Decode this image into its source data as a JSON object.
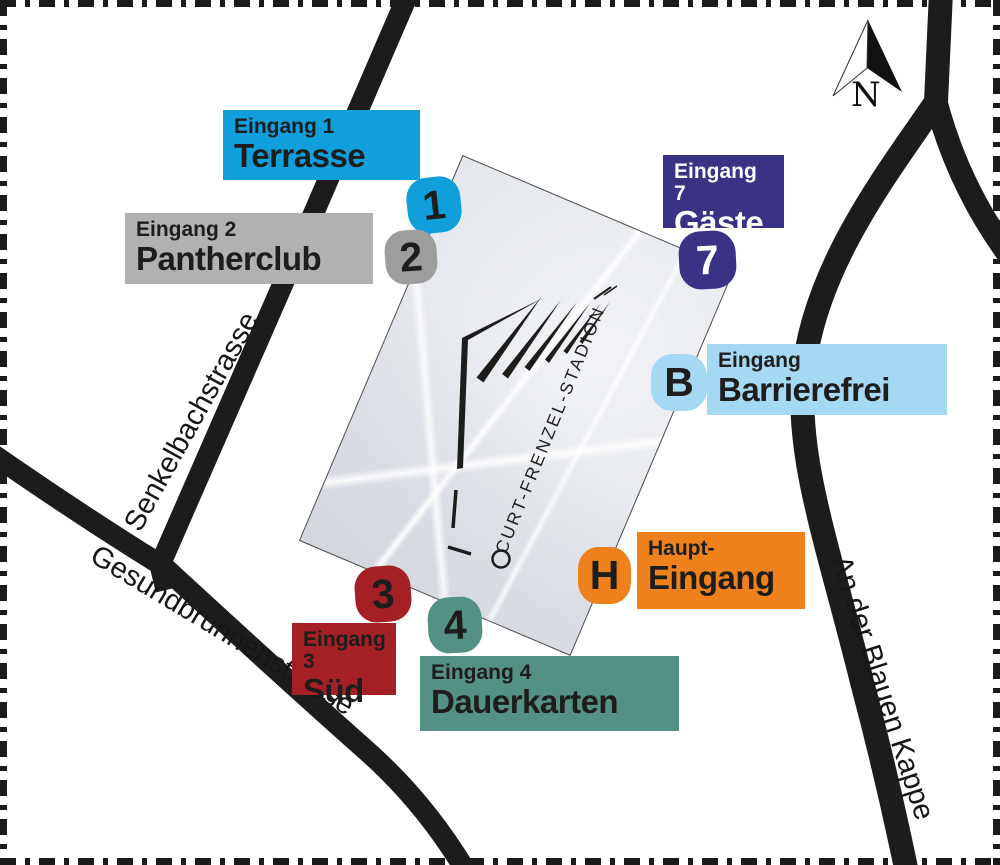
{
  "compass": {
    "label": "N"
  },
  "stadium": {
    "name": "CURT-FRENZEL-STADION"
  },
  "streets": {
    "senkelbach": {
      "name": "Senkelbachstrasse"
    },
    "gesundbrunnen": {
      "name": "Gesundbrunnenstrasse"
    },
    "blauekappe": {
      "name": "An der Blauen Kappe"
    }
  },
  "entrances": {
    "terrasse": {
      "badge": "1",
      "line1": "Eingang 1",
      "line2": "Terrasse",
      "bg": "#119fdc",
      "badge_bg": "#119fdc",
      "fg": "#1d1d1b",
      "badge_fg": "#1d1d1b"
    },
    "pantherclub": {
      "badge": "2",
      "line1": "Eingang 2",
      "line2": "Pantherclub",
      "bg": "#b1b1b0",
      "badge_bg": "#9d9d9c",
      "fg": "#1d1d1b",
      "badge_fg": "#1d1d1b"
    },
    "gaeste": {
      "badge": "7",
      "line1": "Eingang 7",
      "line2": "Gäste",
      "bg": "#3a3285",
      "badge_bg": "#3a3285",
      "fg": "#ffffff",
      "badge_fg": "#ffffff"
    },
    "barrierefrei": {
      "badge": "B",
      "line1": "Eingang",
      "line2": "Barrierefrei",
      "bg": "#a5d8f3",
      "badge_bg": "#a5d8f3",
      "fg": "#1d1d1b",
      "badge_fg": "#1d1d1b"
    },
    "haupteingang": {
      "badge": "H",
      "line1": "Haupt-",
      "line2": "Eingang",
      "bg": "#ef811d",
      "badge_bg": "#ef811d",
      "fg": "#1d1d1b",
      "badge_fg": "#1d1d1b"
    },
    "sued": {
      "badge": "3",
      "line1": "Eingang 3",
      "line2": "Süd",
      "bg": "#a42025",
      "badge_bg": "#a42025",
      "fg": "#1d1d1b",
      "badge_fg": "#1d1d1b"
    },
    "dauerkarten": {
      "badge": "4",
      "line1": "Eingang 4",
      "line2": "Dauerkarten",
      "bg": "#549083",
      "badge_bg": "#549083",
      "fg": "#1d1d1b",
      "badge_fg": "#1d1d1b"
    }
  }
}
